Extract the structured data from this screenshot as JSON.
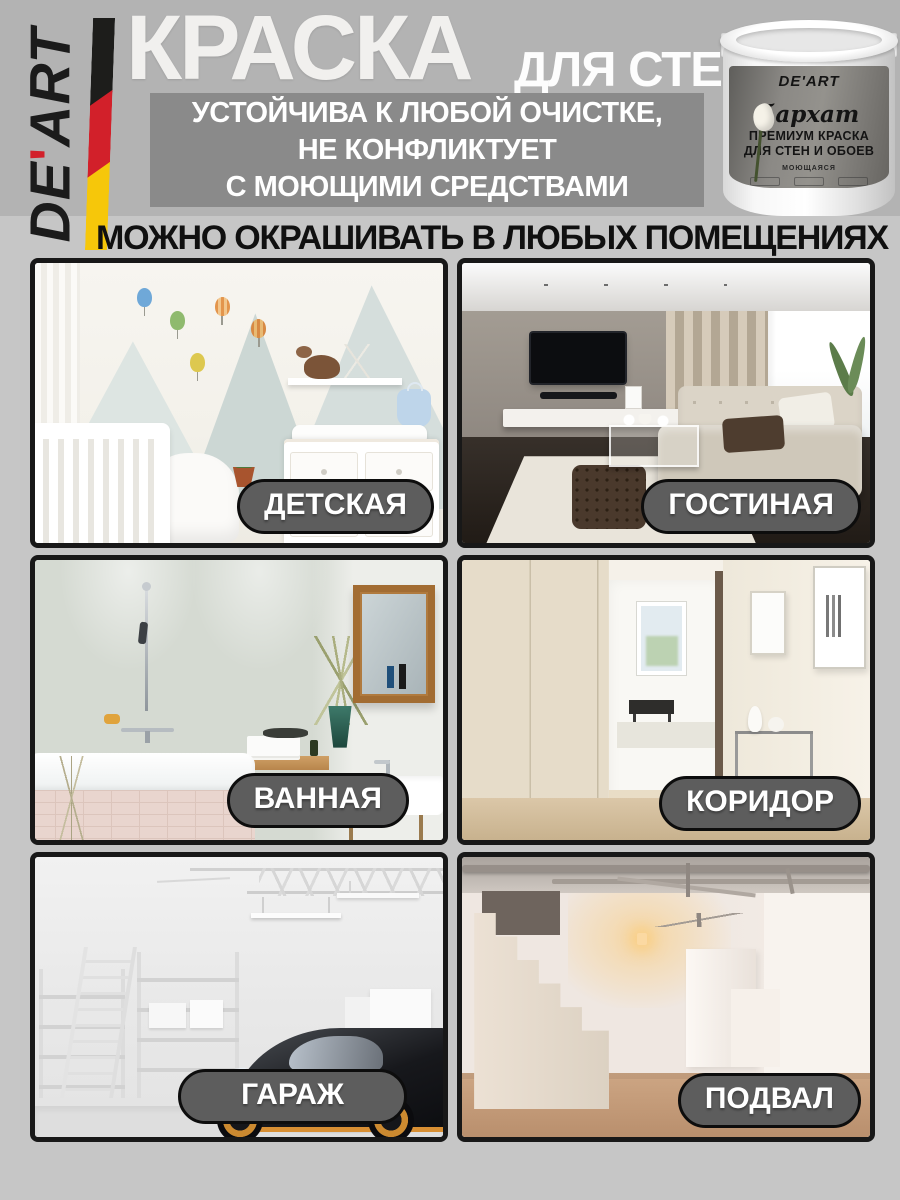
{
  "meta": {
    "page_bg": "#c6c6c6",
    "header_bg": "#b3b3b3",
    "benefit_box_bg": "#8a8a8a",
    "badge_bg": "#5d5d5d",
    "badge_border": "#0d0d0d",
    "badge_text_color": "#ffffff"
  },
  "brand": {
    "name": "DE'ART",
    "name_prefix": "DE",
    "name_apostrophe": "'",
    "name_suffix": "ART",
    "flag_colors": {
      "black": "#1d1d1b",
      "red": "#d2202a",
      "yellow": "#f6c70a"
    }
  },
  "header": {
    "title_main": "КРАСКА",
    "title_sub": "ДЛЯ СТЕН",
    "benefit_lines": [
      "УСТОЙЧИВА К ЛЮБОЙ ОЧИСТКЕ,",
      "НЕ КОНФЛИКТУЕТ",
      "С МОЮЩИМИ СРЕДСТВАМИ"
    ]
  },
  "product_can": {
    "brand": "DE'ART",
    "series": "бархат",
    "line1": "ПРЕМИУМ КРАСКА",
    "line2": "ДЛЯ СТЕН И ОБОЕВ",
    "note": "МОЮЩАЯСЯ"
  },
  "headline": "МОЖНО ОКРАШИВАТЬ В ЛЮБЫХ ПОМЕЩЕНИЯХ",
  "rooms": [
    {
      "id": "nursery",
      "label": "ДЕТСКАЯ"
    },
    {
      "id": "living-room",
      "label": "ГОСТИНАЯ"
    },
    {
      "id": "bathroom",
      "label": "ВАННАЯ"
    },
    {
      "id": "corridor",
      "label": "КОРИДОР"
    },
    {
      "id": "garage",
      "label": "ГАРАЖ"
    },
    {
      "id": "basement",
      "label": "ПОДВАЛ"
    }
  ]
}
